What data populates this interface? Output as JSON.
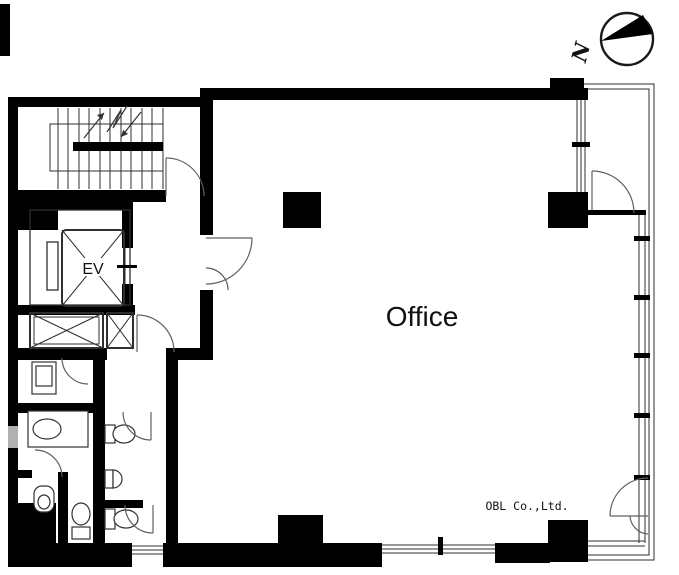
{
  "page": {
    "background": "#ffffff"
  },
  "labels": {
    "office_room": "Office",
    "elevator": "EV",
    "company_credit": "OBL Co.,Ltd.",
    "compass_north": "N"
  },
  "colors": {
    "wall": "#000000",
    "line": "#2f2f2f",
    "arc": "#606060",
    "background": "#ffffff",
    "text": "#111111",
    "window_gray": "#b0b0b0"
  },
  "icons": {
    "compass": "compass-north-icon",
    "stair_direction": "stair-direction-arrow-icon",
    "elevator_cross": "elevator-shaft-x-icon",
    "pipe_shaft": "pipe-shaft-x-icon",
    "door": "door-swing-arc-icon",
    "toilet": "toilet-icon",
    "urinal": "urinal-icon",
    "basin": "wash-basin-icon"
  }
}
